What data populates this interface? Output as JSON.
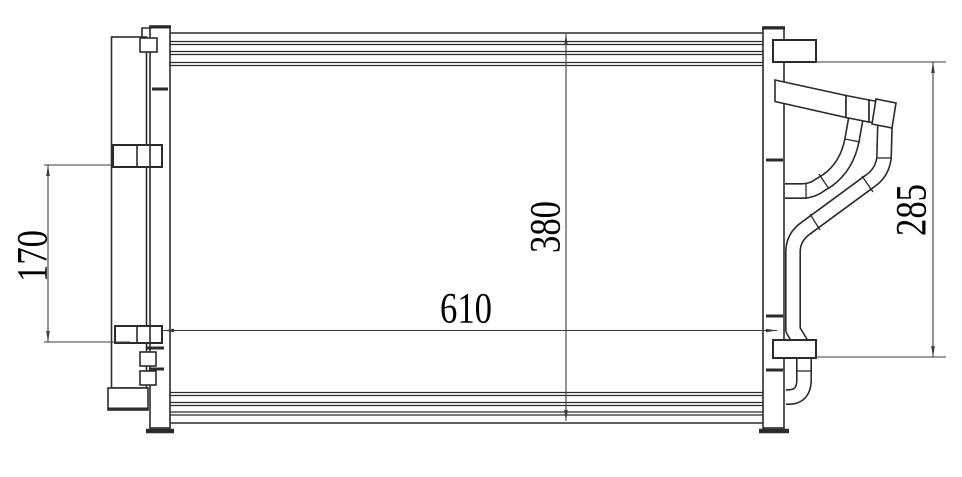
{
  "figure": {
    "kind": "engineering line drawing",
    "subject": "AC condenser front view with receiver drier, mounting brackets and outlet pipes"
  },
  "colors": {
    "line": "#2b2b2b",
    "dimension": "#3c3c3c",
    "background": "#ffffff",
    "label": "#000000"
  },
  "dimensions": {
    "left_bracket_spacing": "170",
    "core_height": "380",
    "core_width": "610",
    "right_bracket_height": "285"
  }
}
